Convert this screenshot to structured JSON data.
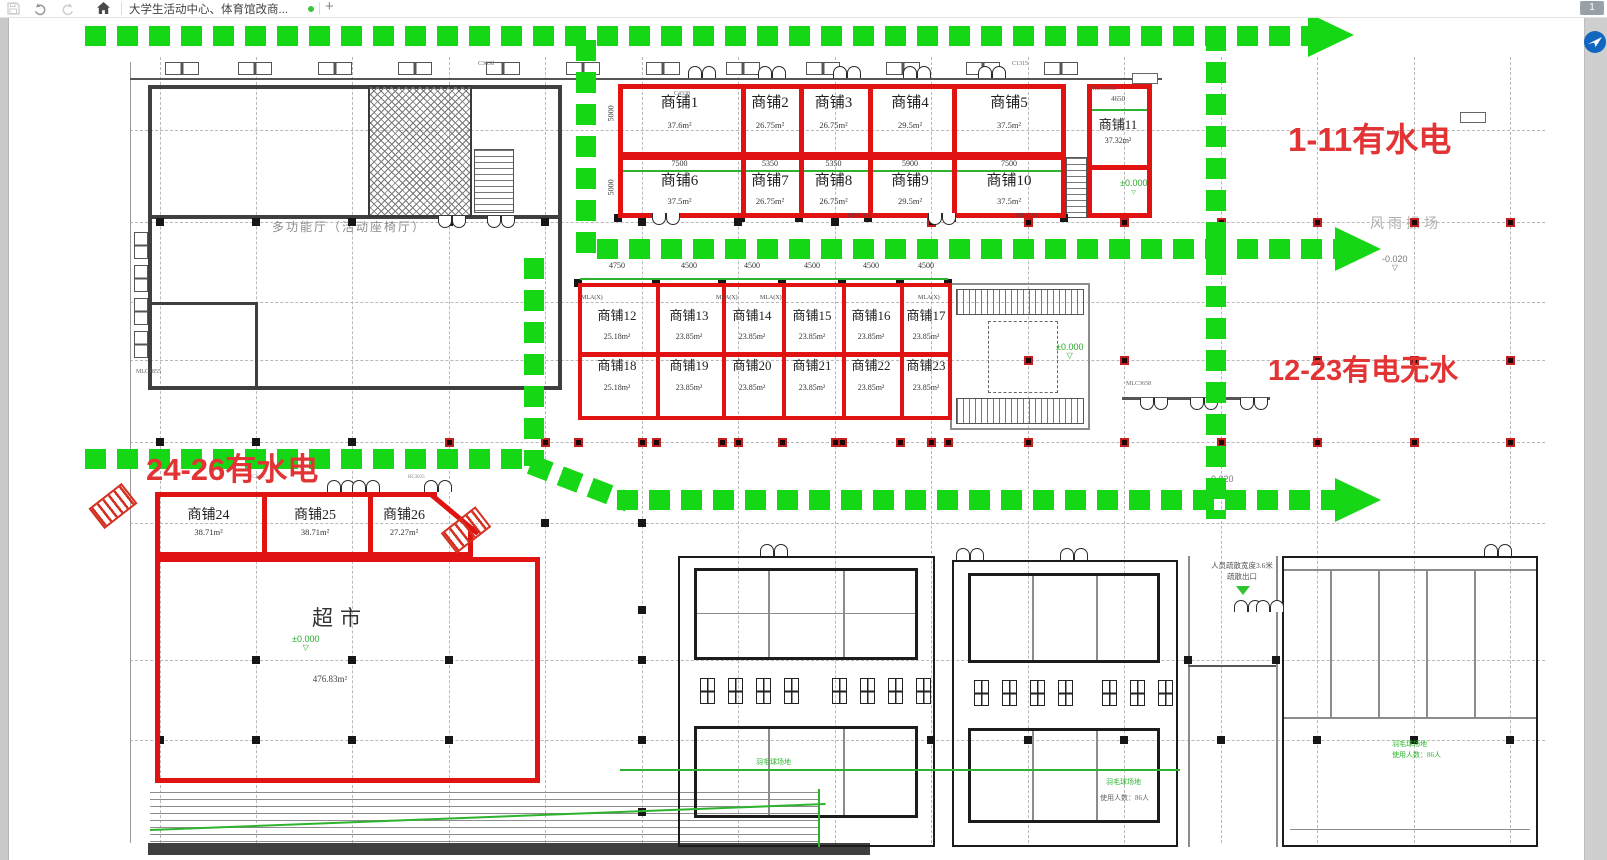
{
  "toolbar": {
    "tab_title": "大学生活动中心、体育馆改商...",
    "add_label": "+"
  },
  "page_badge": "1",
  "annotations": {
    "a1": "1-11有水电",
    "a2": "12-23有电无水",
    "a3": "24-26有水电"
  },
  "rooms": {
    "multi_hall": "多功能厅（活动座椅厅）",
    "playground": "风雨操场",
    "supermarket_name": "超市",
    "supermarket_area": "476.83m²",
    "evac_line1": "人员疏散宽度3.6米",
    "evac_line2": "疏散出口"
  },
  "shops": {
    "row1_top": [
      {
        "name": "商铺1",
        "area": "37.6m²"
      },
      {
        "name": "商铺2",
        "area": "26.75m²"
      },
      {
        "name": "商铺3",
        "area": "26.75m²"
      },
      {
        "name": "商铺4",
        "area": "29.5m²"
      },
      {
        "name": "商铺5",
        "area": "37.5m²"
      }
    ],
    "row1_bottom": [
      {
        "name": "商铺6",
        "area": "37.5m²"
      },
      {
        "name": "商铺7",
        "area": "26.75m²"
      },
      {
        "name": "商铺8",
        "area": "26.75m²"
      },
      {
        "name": "商铺9",
        "area": "29.5m²"
      },
      {
        "name": "商铺10",
        "area": "37.5m²"
      }
    ],
    "row1_dims": [
      "7500",
      "5350",
      "5350",
      "5900",
      "7500"
    ],
    "row1_side_dim": "5000",
    "shop11": {
      "name": "商铺11",
      "area": "37.32m²",
      "dim": "4650",
      "code": "MLC3338"
    },
    "row2_top": [
      {
        "name": "商铺12",
        "area": "25.18m²"
      },
      {
        "name": "商铺13",
        "area": "23.85m²"
      },
      {
        "name": "商铺14",
        "area": "23.85m²"
      },
      {
        "name": "商铺15",
        "area": "23.85m²"
      },
      {
        "name": "商铺16",
        "area": "23.85m²"
      },
      {
        "name": "商铺17",
        "area": "23.85m²"
      }
    ],
    "row2_bottom": [
      {
        "name": "商铺18",
        "area": "25.18m²"
      },
      {
        "name": "商铺19",
        "area": "23.85m²"
      },
      {
        "name": "商铺20",
        "area": "23.85m²"
      },
      {
        "name": "商铺21",
        "area": "23.85m²"
      },
      {
        "name": "商铺22",
        "area": "23.85m²"
      },
      {
        "name": "商铺23",
        "area": "23.85m²"
      }
    ],
    "row2_dims": [
      "4750",
      "4500",
      "4500",
      "4500",
      "4500",
      "4500"
    ],
    "row3": [
      {
        "name": "商铺24",
        "area": "38.71m²"
      },
      {
        "name": "商铺25",
        "area": "38.71m²"
      },
      {
        "name": "商铺26",
        "area": "27.27m²"
      }
    ]
  },
  "cad_labels": {
    "mla": "MLA(X)",
    "m1a": "M1A(X)",
    "mlc3658": "MLC3658",
    "mlc1855": "MLC1855",
    "c3638": "C3638",
    "c4338": "C4338",
    "c1315": "C1315",
    "rc3025": "RC3025",
    "elev_zero": "±0.000",
    "elev_neg": "-0.020"
  },
  "court_notes": {
    "green": "羽毛球场地",
    "gray": "使用人数：86人"
  }
}
